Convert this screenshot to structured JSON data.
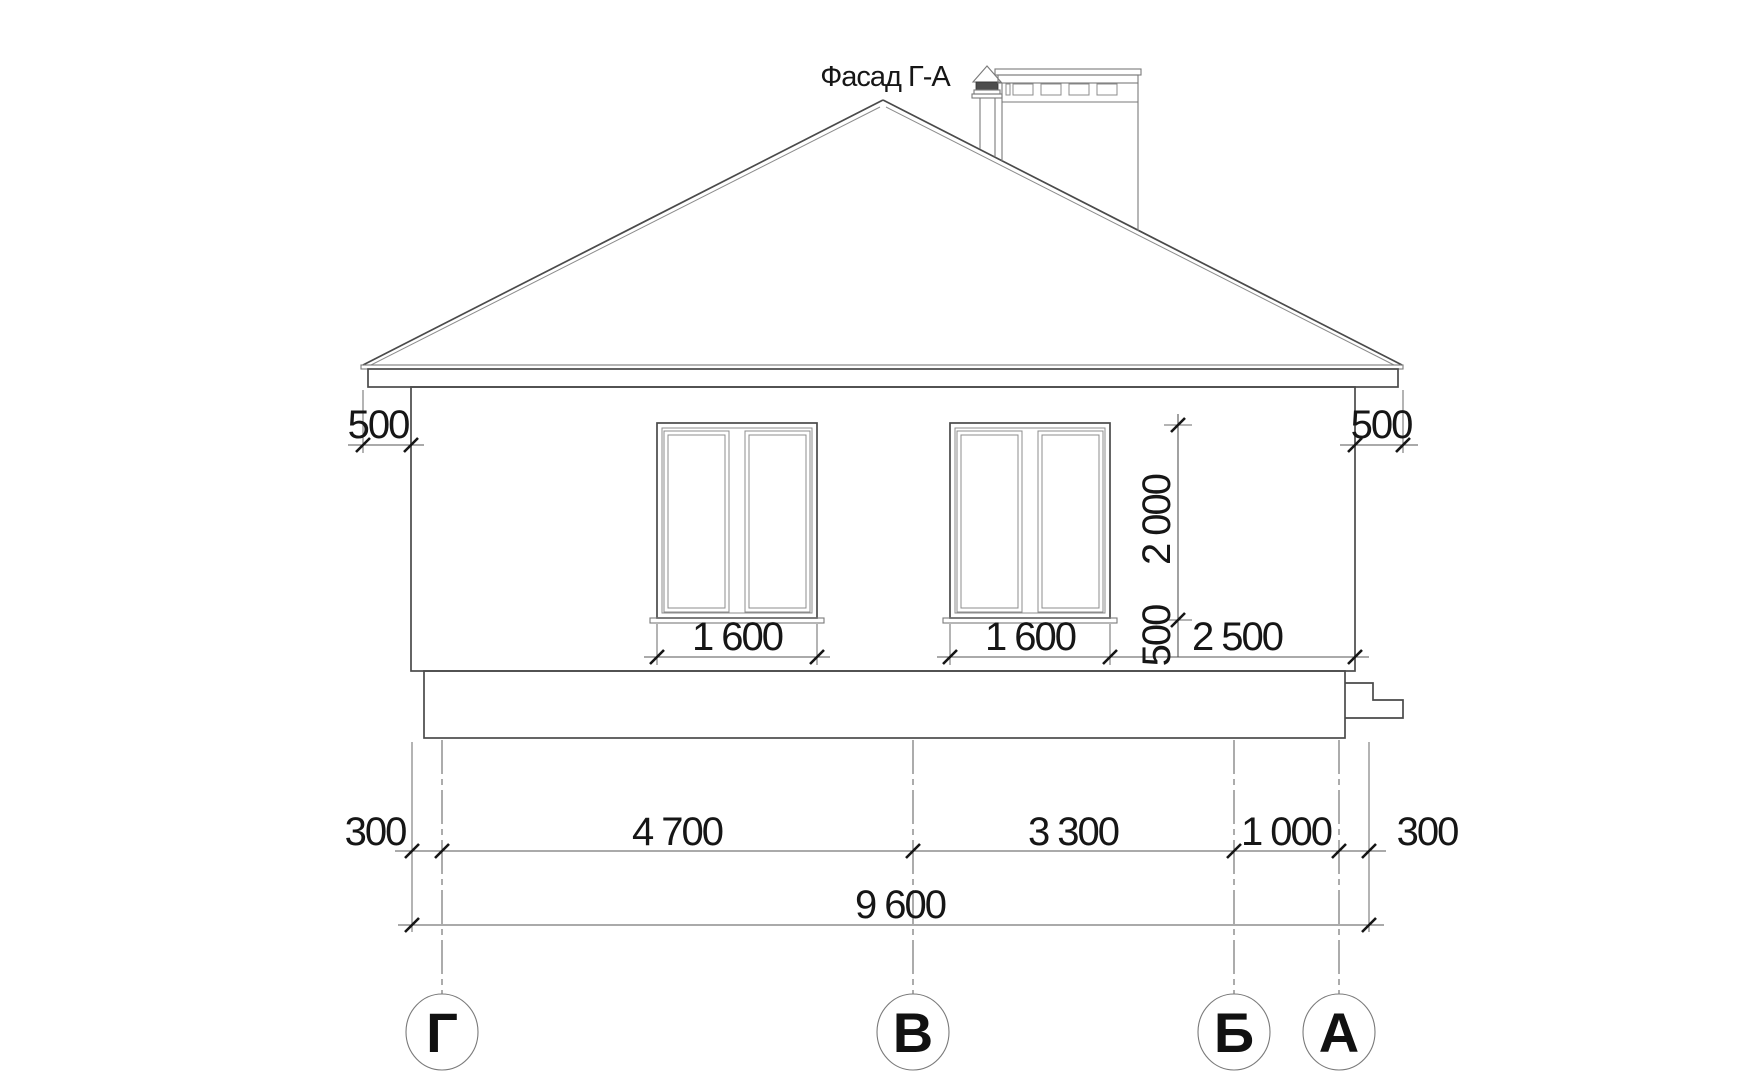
{
  "title": "Фасад Г-А",
  "colors": {
    "background": "#ffffff",
    "line": "#4a4a4a",
    "line_heavy": "#161616",
    "line_light": "#8c8c8c",
    "text": "#161616"
  },
  "dimensions": {
    "eave_overhang_left": "500",
    "eave_overhang_right": "500",
    "window_width_left": "1 600",
    "window_width_right": "1 600",
    "window_height": "2 000",
    "sill_offset": "500",
    "window_to_corner": "2 500",
    "spacing_row": [
      "300",
      "4 700",
      "3 300",
      "1 000",
      "300"
    ],
    "overall_width": "9 600"
  },
  "axes": [
    {
      "label": "Г"
    },
    {
      "label": "В"
    },
    {
      "label": "Б"
    },
    {
      "label": "А"
    }
  ]
}
